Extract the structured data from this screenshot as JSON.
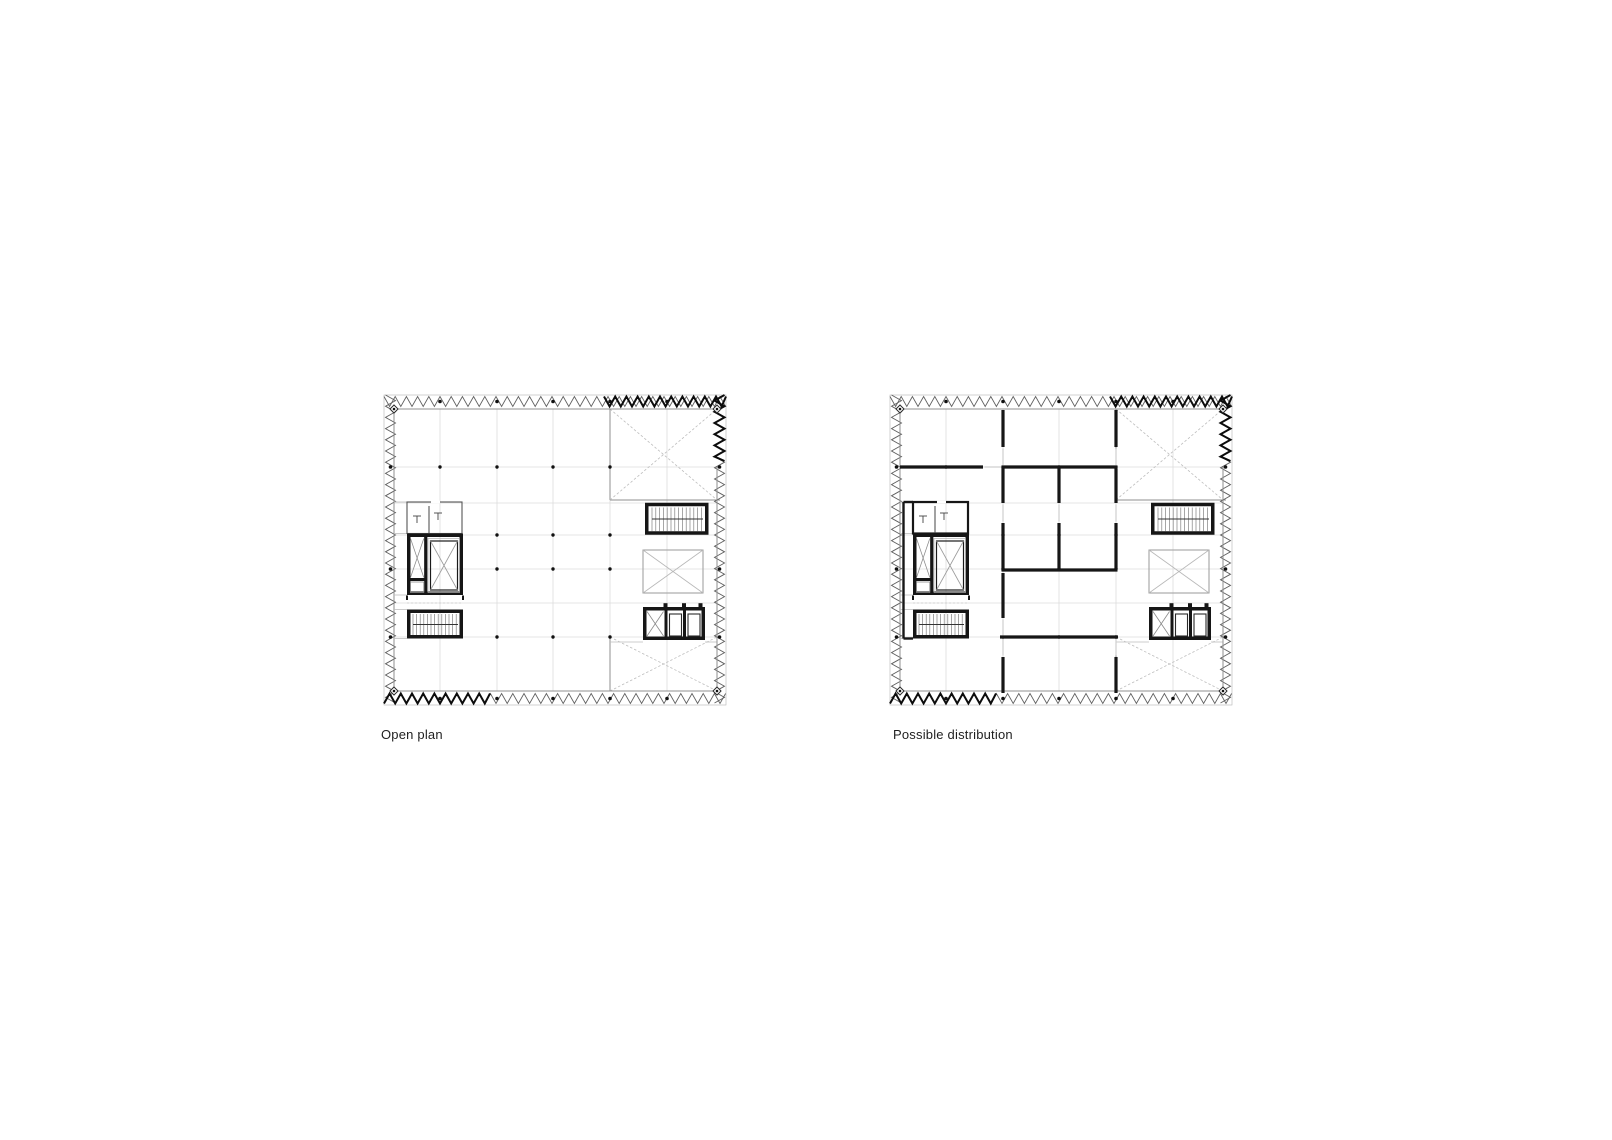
{
  "canvas": {
    "width": 1612,
    "height": 1140,
    "background": "#ffffff"
  },
  "palette": {
    "wall": "#161616",
    "line_dark": "#3f3f3f",
    "line_mid": "#8f8f8f",
    "line_light": "#bdbdbd",
    "grid": "#dcdcdc",
    "dot": "#111111",
    "facade": "#5f5f5f",
    "facade_bold": "#0c0c0c",
    "text": "#1f1f1f"
  },
  "figures": [
    {
      "id": "open-plan",
      "label": "Open plan",
      "variant": "open",
      "elements": [
        "sawtooth-facade",
        "column-grid-dots",
        "wc-block",
        "elevator-core",
        "stair-west",
        "stair-east",
        "service-shaft",
        "elevator-bank",
        "void-northeast",
        "void-southeast"
      ]
    },
    {
      "id": "possible-distribution",
      "label": "Possible distribution",
      "variant": "partitioned",
      "elements": [
        "sawtooth-facade",
        "column-grid-dots",
        "wc-block",
        "elevator-core",
        "stair-west",
        "stair-east",
        "service-shaft",
        "elevator-bank",
        "void-northeast",
        "void-southeast",
        "partition-walls",
        "door-openings"
      ]
    }
  ]
}
